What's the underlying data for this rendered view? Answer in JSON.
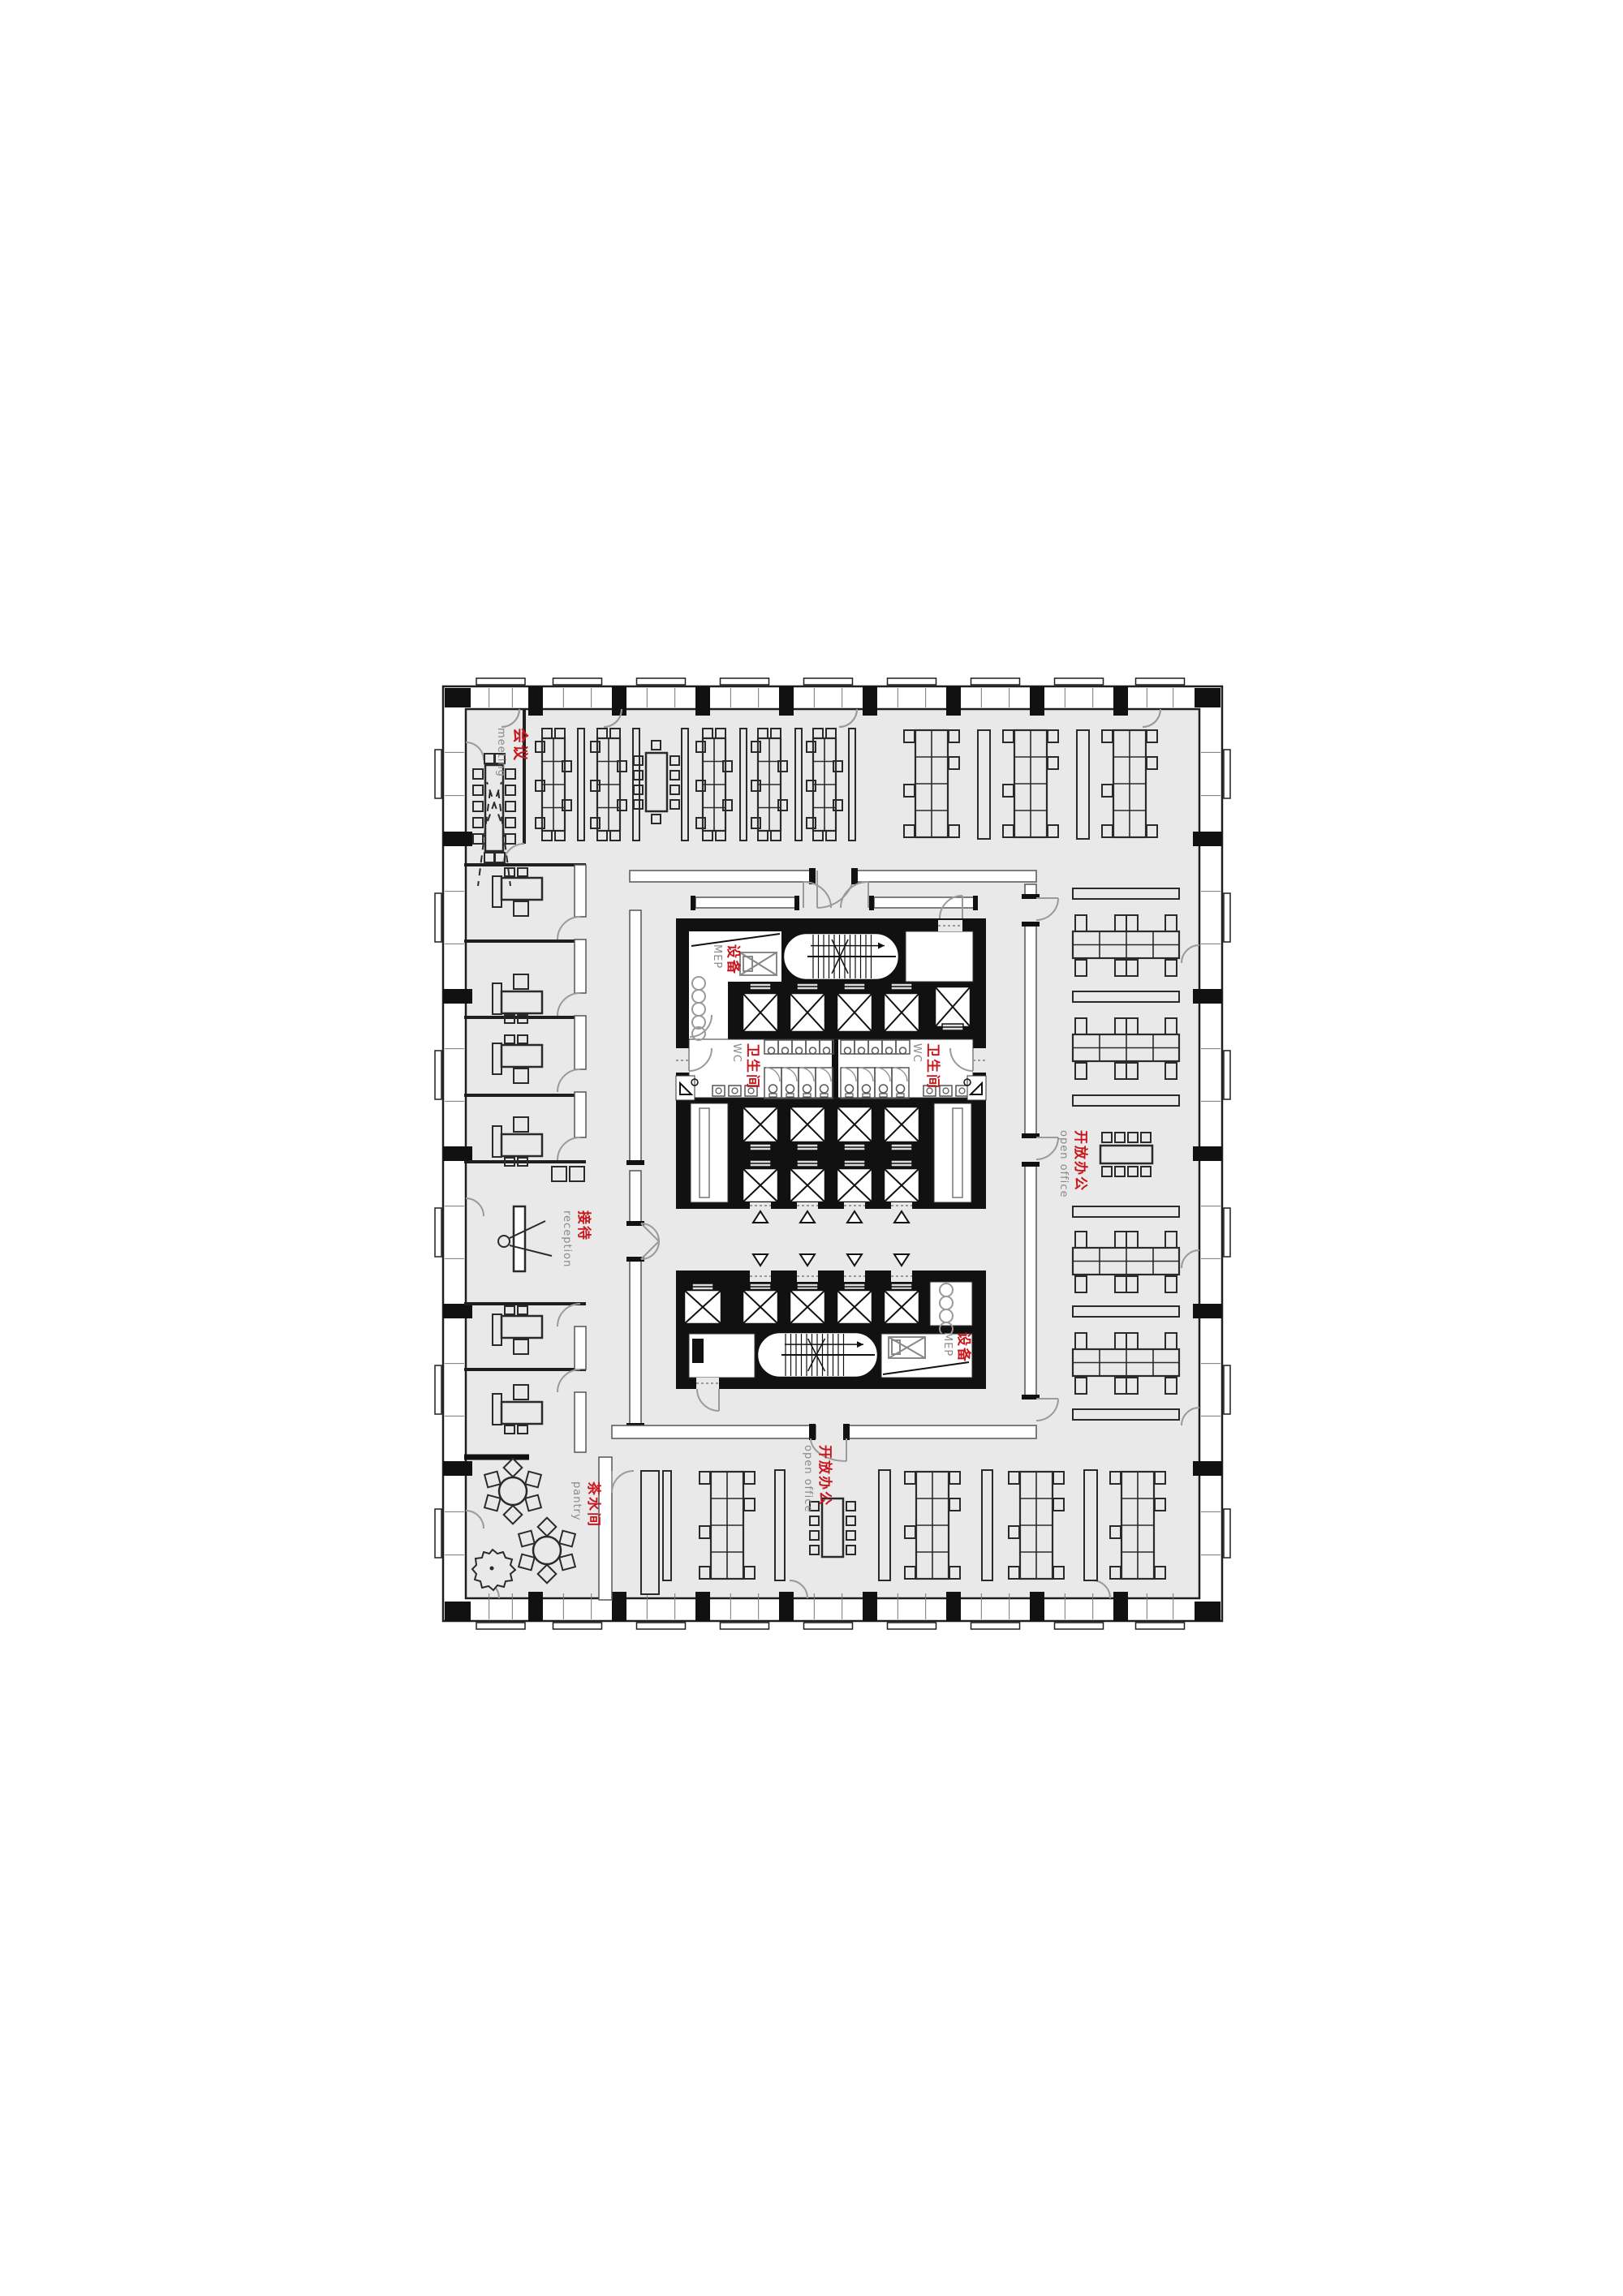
{
  "document": {
    "type": "office tower floor plan",
    "sheet_background": "#ffffff",
    "floor_fill": "#e9e9e9"
  },
  "colors": {
    "label_red": "#c8161d",
    "label_gray": "#8a8a8a",
    "wall_black": "#111111",
    "line_dark": "#1f1f1f",
    "furniture_line": "#2a2a2a",
    "partition_outline": "#555555",
    "door_swing": "#9a9a9a",
    "floor_gray": "#e9e9e9",
    "room_white": "#ffffff"
  },
  "labels": {
    "meeting": {
      "zh": "会议",
      "en": "meeting"
    },
    "reception": {
      "zh": "接待",
      "en": "reception"
    },
    "pantry": {
      "zh": "茶水间",
      "en": "pantry"
    },
    "open_office_right": {
      "zh": "开放办公",
      "en": "open office"
    },
    "open_office_bottom": {
      "zh": "开放办公",
      "en": "open office"
    },
    "mep_upper": {
      "zh": "设备",
      "en": "MEP"
    },
    "mep_lower": {
      "zh": "设备",
      "en": "MEP"
    },
    "wc_left": {
      "zh": "卫生间",
      "en": "WC"
    },
    "wc_right": {
      "zh": "卫生间",
      "en": "WC"
    }
  }
}
